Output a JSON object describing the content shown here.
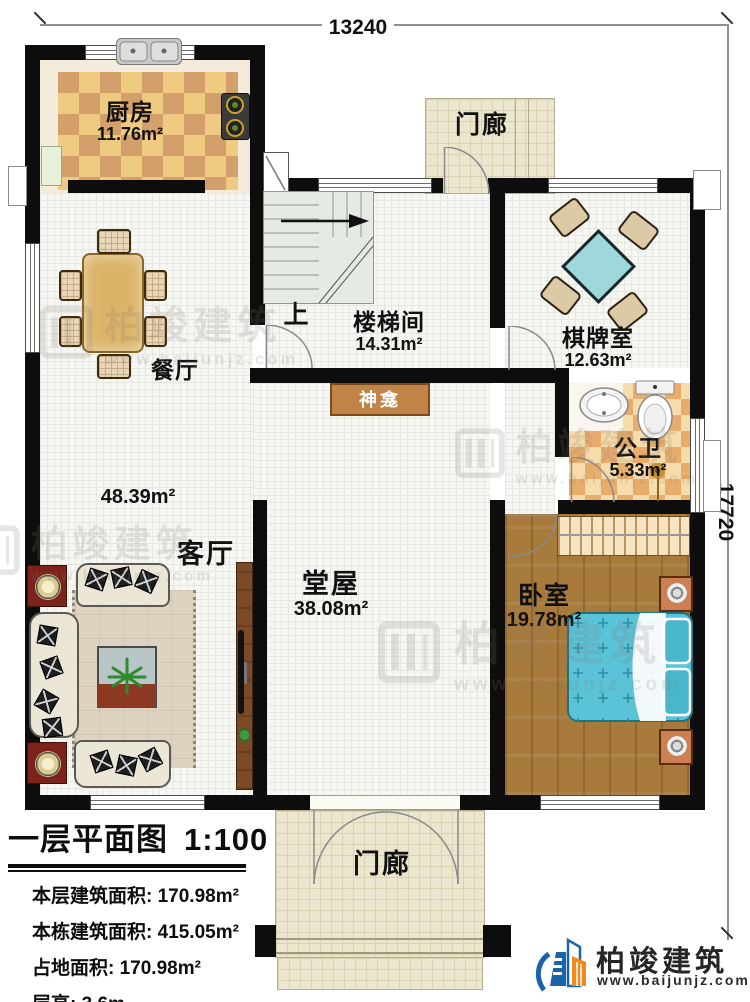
{
  "plan": {
    "dim_top": "13240",
    "dim_right": "17720",
    "rooms": {
      "kitchen": {
        "name": "厨房",
        "area": "11.76m²"
      },
      "dining": {
        "name": "餐厅"
      },
      "stairwell": {
        "name": "楼梯间",
        "area": "14.31m²",
        "up_label": "上"
      },
      "porch_top": {
        "name": "门廊"
      },
      "chess": {
        "name": "棋牌室",
        "area": "12.63m²"
      },
      "bath": {
        "name": "公卫",
        "area": "5.33m²"
      },
      "living": {
        "name": "客厅",
        "area": "48.39m²"
      },
      "hall": {
        "name": "堂屋",
        "area": "38.08m²"
      },
      "bedroom": {
        "name": "卧室",
        "area": "19.78m²"
      },
      "porch_bottom": {
        "name": "门廊"
      },
      "shrine": {
        "name": "神龛"
      }
    }
  },
  "info_panel": {
    "title": "一层平面图",
    "scale": "1:100",
    "rows": [
      {
        "label": "本层建筑面积:",
        "value": "170.98m²"
      },
      {
        "label": "本栋建筑面积:",
        "value": "415.05m²"
      },
      {
        "label": "占地面积:",
        "value": "170.98m²"
      },
      {
        "label": "层高:",
        "value": "3.6m"
      }
    ]
  },
  "branding": {
    "company": "柏竣建筑",
    "website": "www.baijunjz.com"
  },
  "watermark": {
    "text": "柏竣建筑",
    "site": "www.baijunjz.com"
  },
  "colors": {
    "wall": "#0d0d0d",
    "accent_blue": "#1c64aa",
    "accent_orange": "#ef8a1c",
    "bed": "#5ac3d8",
    "chess_table": "#9ed8da"
  }
}
